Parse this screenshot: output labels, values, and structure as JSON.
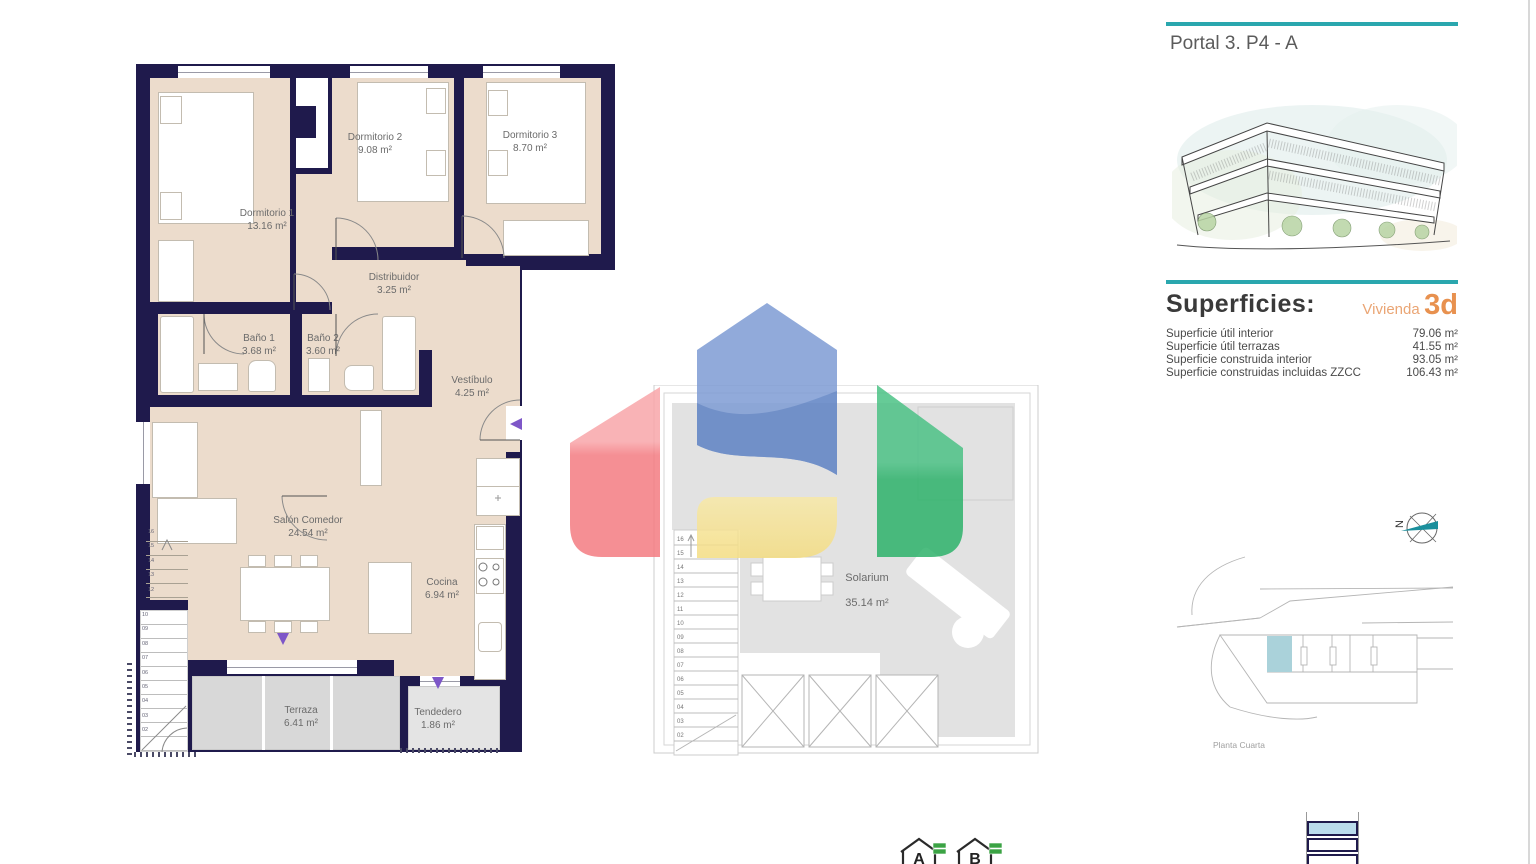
{
  "header": {
    "title": "Portal 3. P4 - A"
  },
  "superficies": {
    "heading": "Superficies:",
    "vivienda_label": "Vivienda",
    "vivienda_value": "3d",
    "rows": [
      {
        "label": "Superficie útil interior",
        "value": "79.06 m²"
      },
      {
        "label": "Superficie útil terrazas",
        "value": "41.55 m²"
      },
      {
        "label": "Superficie construida interior",
        "value": "93.05 m²"
      },
      {
        "label": "Superficie construidas incluidas ZZCC",
        "value": "106.43 m²"
      }
    ]
  },
  "floor_plan": {
    "rooms": [
      {
        "name": "Dormitorio 1",
        "area": "13.16 m²"
      },
      {
        "name": "Dormitorio 2",
        "area": "9.08 m²"
      },
      {
        "name": "Dormitorio 3",
        "area": "8.70 m²"
      },
      {
        "name": "Distribuidor",
        "area": "3.25 m²"
      },
      {
        "name": "Baño 1",
        "area": "3.68 m²"
      },
      {
        "name": "Baño 2",
        "area": "3.60 m²"
      },
      {
        "name": "Vestíbulo",
        "area": "4.25 m²"
      },
      {
        "name": "Salón Comedor",
        "area": "24.54 m²"
      },
      {
        "name": "Cocina",
        "area": "6.94 m²"
      },
      {
        "name": "Terraza",
        "area": "6.41 m²"
      },
      {
        "name": "Tendedero",
        "area": "1.86 m²"
      }
    ],
    "stairs_upper": [
      "16",
      "15",
      "14",
      "13",
      "12"
    ],
    "stairs_lower": [
      "10",
      "09",
      "08",
      "07",
      "06",
      "05",
      "04",
      "03",
      "02"
    ]
  },
  "solarium": {
    "name": "Solarium",
    "area": "35.14 m²",
    "stairs": [
      "16",
      "15",
      "14",
      "13",
      "12",
      "11",
      "10",
      "09",
      "08",
      "07",
      "06",
      "05",
      "04",
      "03",
      "02"
    ]
  },
  "site_plan": {
    "caption": "Planta Cuarta"
  },
  "compass": {
    "label": "N"
  },
  "energy": {
    "labels": [
      "A",
      "B"
    ]
  },
  "colors": {
    "wall": "#1f1a4c",
    "floor": "#ecdccc",
    "terrace": "#d8d8d8",
    "teal": "#2aa7ae",
    "orange": "#e8914f",
    "logo_red": "#f47c82",
    "logo_blue": "#7e9cd4",
    "logo_yellow": "#f6e193",
    "logo_green": "#2eb26b",
    "unit_highlight": "#aad2da",
    "entry_arrow": "#7e57c8"
  }
}
